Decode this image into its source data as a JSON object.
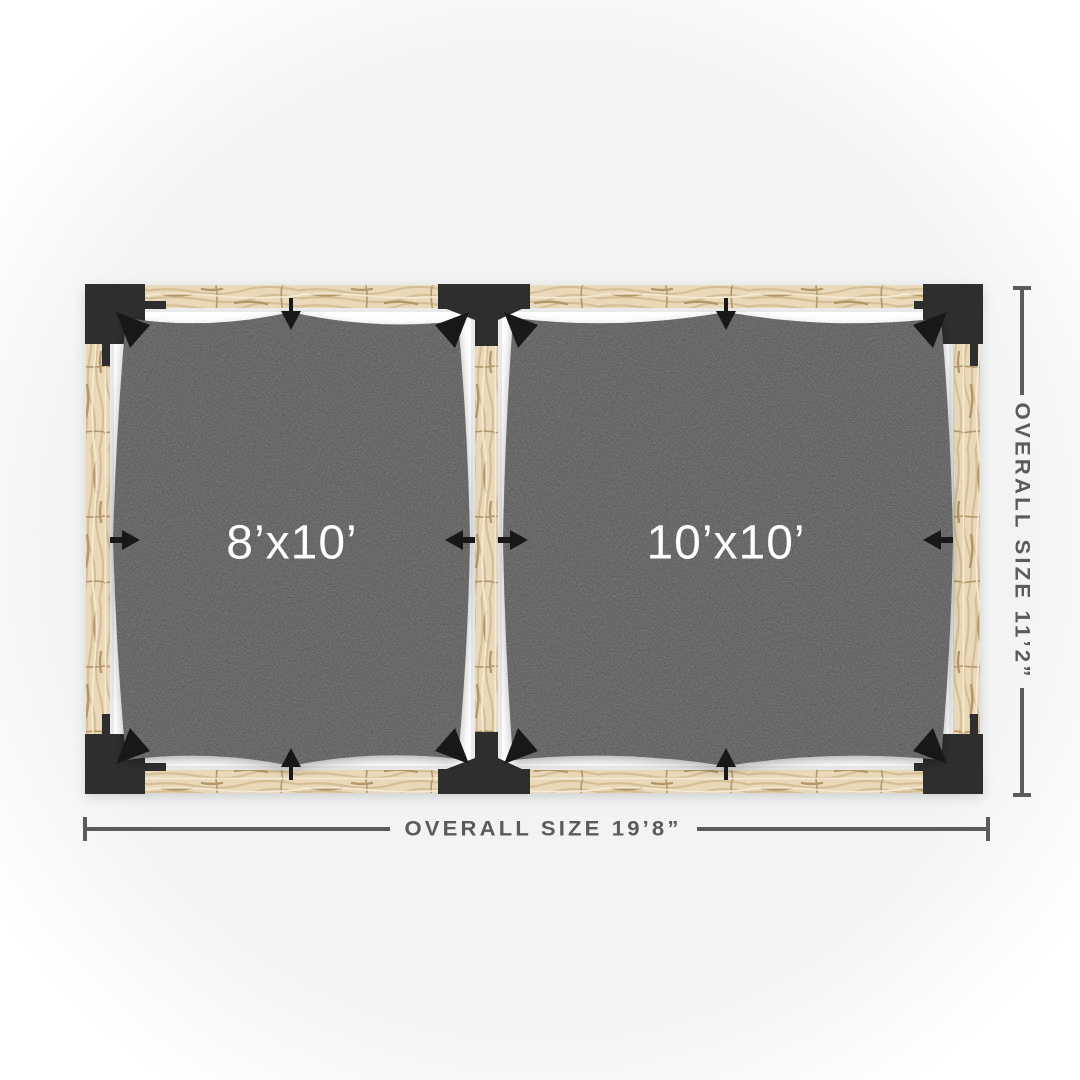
{
  "pergola": {
    "bays": [
      {
        "label": "8’x10’"
      },
      {
        "label": "10’x10’"
      }
    ],
    "dimensions": {
      "width_label": "OVERALL SIZE 19’8”",
      "height_label": "OVERALL SIZE 11’2”"
    },
    "colors": {
      "canvas_center": "#f2f3f3",
      "canvas_edge": "#ffffff",
      "bay_white": "#ffffff",
      "wood_base": "#ead9b8",
      "wood_grain": "#d5bf96",
      "wood_grain_dark": "#b3976a",
      "wood_highlight": "#f6eeda",
      "bracket": "#2e2e2e",
      "hook": "#181818",
      "sail": "#484848",
      "label_text": "#ffffff",
      "dimension": "#5a5b5d"
    }
  }
}
